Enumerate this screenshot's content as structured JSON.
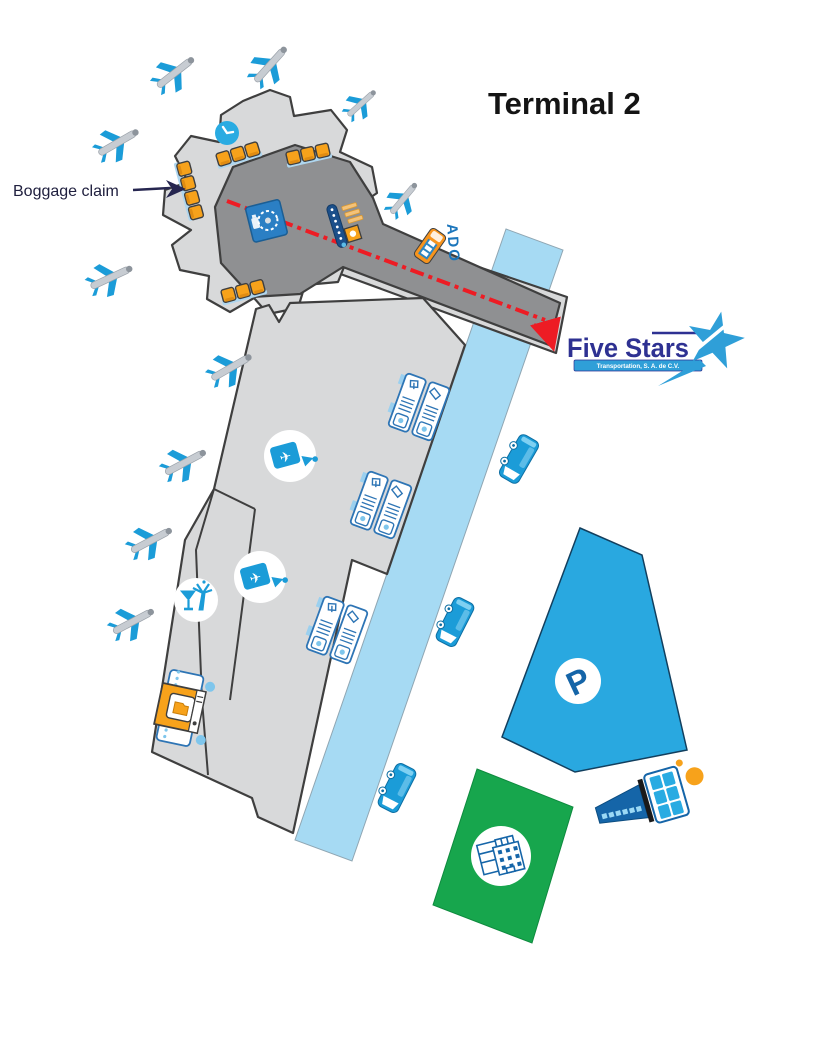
{
  "title": "Terminal 2",
  "labels": {
    "baggage_claim": "Boggage claim",
    "ado": "ADO",
    "parking_symbol": "P"
  },
  "logo": {
    "name": "Five Stars",
    "tagline": "Transportation, S. A. de C.V."
  },
  "icons": {
    "airplane_glyph": "✈",
    "list": [
      "clock-icon",
      "bench-seats",
      "baggage-carousel-icon",
      "escalator-icon",
      "checkin-counter-icon",
      "gate-sign-icon",
      "bar-icon",
      "xray-machine-icon",
      "bus-icon",
      "ado-bus-icon",
      "parking-area",
      "hotel-icon",
      "control-tower-icon",
      "airplane-icon"
    ]
  },
  "colors": {
    "building_light": "#d8d9da",
    "building_dark": "#8f9092",
    "outline": "#3f3f3f",
    "road": "#a6daf3",
    "route_red": "#ed1c24",
    "icon_blue": "#1b9cd8",
    "accent_orange": "#f7a21b",
    "parking_blue": "#29a8e0",
    "green_zone": "#17a64d",
    "logo_navy": "#2e3192",
    "ado_blue": "#1b75bb"
  }
}
